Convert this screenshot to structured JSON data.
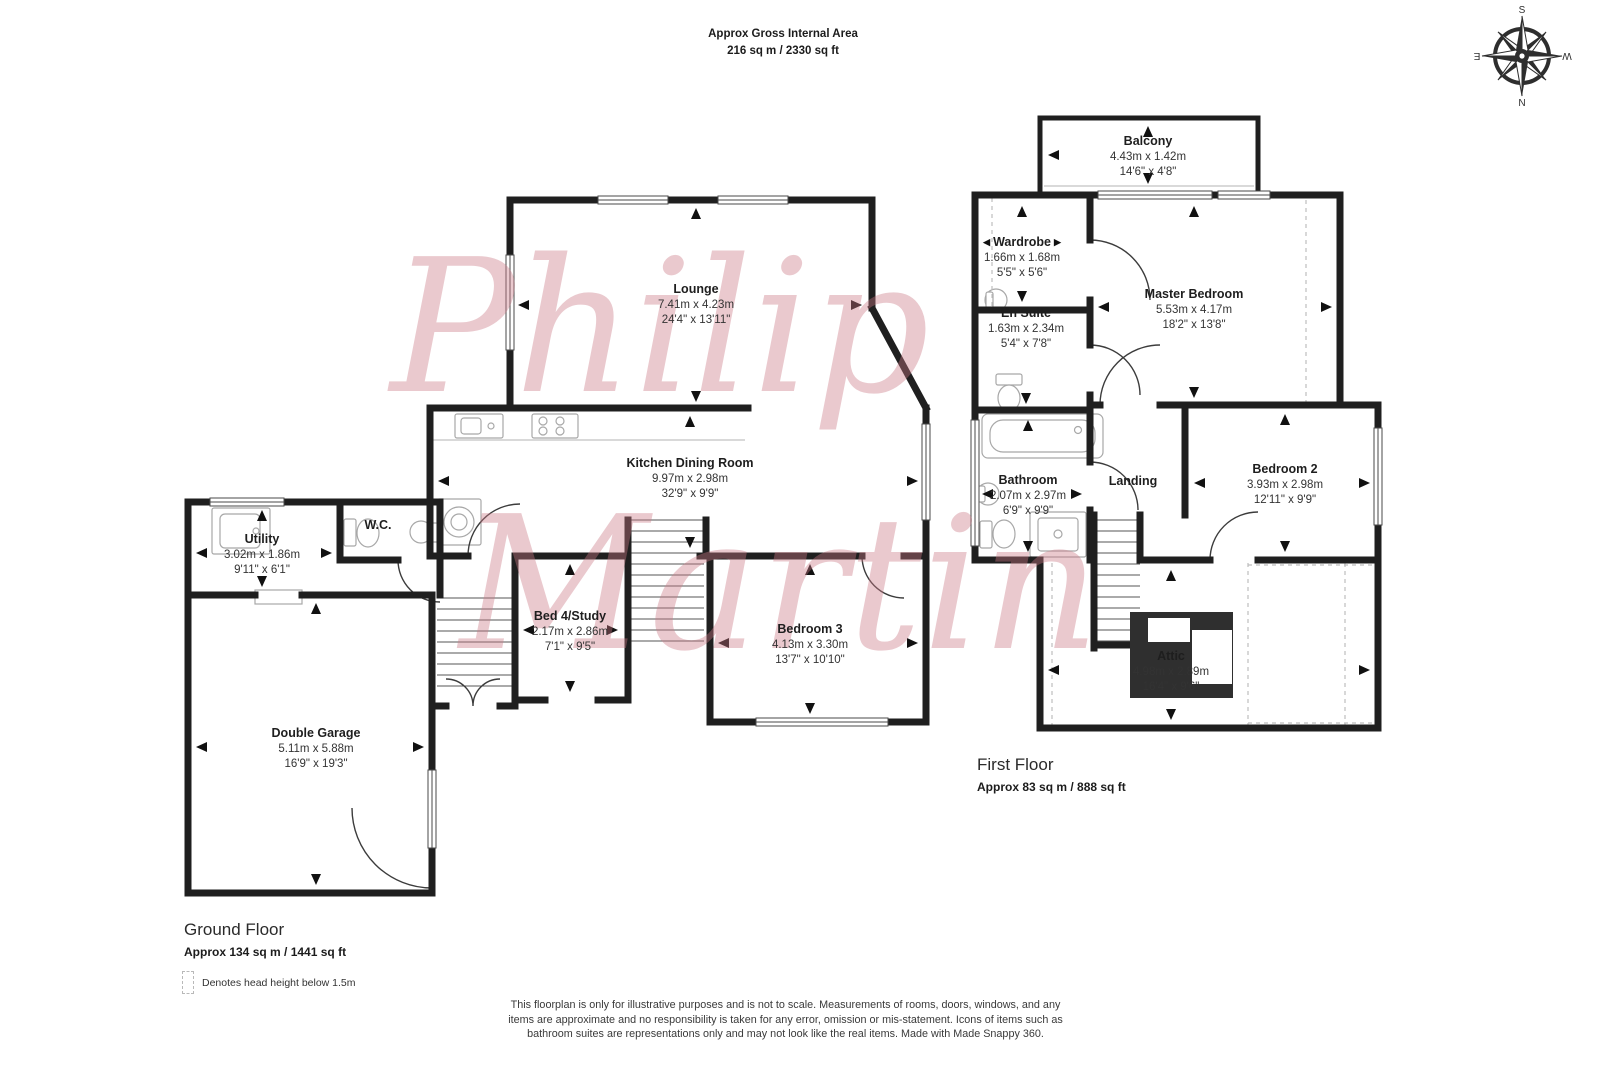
{
  "header": {
    "title": "Approx Gross Internal Area",
    "area": "216 sq m / 2330 sq ft"
  },
  "compass": {
    "north": "N",
    "south": "S",
    "east": "E",
    "west": "W"
  },
  "watermark": {
    "line1": "Philip",
    "line2": "Martin"
  },
  "rooms": {
    "lounge": {
      "name": "Lounge",
      "metric": "7.41m x 4.23m",
      "imperial": "24'4\" x 13'11\""
    },
    "kitchen": {
      "name": "Kitchen Dining Room",
      "metric": "9.97m x 2.98m",
      "imperial": "32'9\" x 9'9\""
    },
    "utility": {
      "name": "Utility",
      "metric": "3.02m x 1.86m",
      "imperial": "9'11\" x 6'1\""
    },
    "wc": {
      "name": "W.C."
    },
    "bed4": {
      "name": "Bed 4/Study",
      "metric": "2.17m x 2.86m",
      "imperial": "7'1\" x 9'5\""
    },
    "bedroom3": {
      "name": "Bedroom 3",
      "metric": "4.13m x 3.30m",
      "imperial": "13'7\" x 10'10\""
    },
    "garage": {
      "name": "Double Garage",
      "metric": "5.11m x 5.88m",
      "imperial": "16'9\" x 19'3\""
    },
    "balcony": {
      "name": "Balcony",
      "metric": "4.43m x 1.42m",
      "imperial": "14'6\" x 4'8\""
    },
    "wardrobe": {
      "name": "Wardrobe",
      "metric": "1.66m x 1.68m",
      "imperial": "5'5\" x 5'6\""
    },
    "ensuite": {
      "name": "En Suite",
      "metric": "1.63m x 2.34m",
      "imperial": "5'4\" x 7'8\""
    },
    "master": {
      "name": "Master Bedroom",
      "metric": "5.53m x 4.17m",
      "imperial": "18'2\" x 13'8\""
    },
    "bathroom": {
      "name": "Bathroom",
      "metric": "2.07m x 2.97m",
      "imperial": "6'9\" x 9'9\""
    },
    "landing": {
      "name": "Landing"
    },
    "bedroom2": {
      "name": "Bedroom 2",
      "metric": "3.93m x 2.98m",
      "imperial": "12'11\" x 9'9\""
    },
    "attic": {
      "name": "Attic",
      "metric": "4.98m x 2.89m",
      "imperial": "16'4\" x 9'6\""
    }
  },
  "floors": {
    "ground": {
      "title": "Ground Floor",
      "area": "Approx 134 sq m / 1441 sq ft"
    },
    "first": {
      "title": "First Floor",
      "area": "Approx 83 sq m / 888 sq ft"
    }
  },
  "legend": {
    "label": "Denotes head height below 1.5m"
  },
  "disclaimer": {
    "text": "This floorplan is only for illustrative purposes and is not to scale. Measurements of rooms, doors, windows, and any items are approximate and no responsibility is taken for any error, omission or mis-statement. Icons of items such as bathroom suites are representations only and may not look like the real items. Made with Made Snappy 360."
  },
  "colors": {
    "wall": "#1f1f1f",
    "watermark": "#ca7885",
    "text": "#2d2d2d"
  }
}
